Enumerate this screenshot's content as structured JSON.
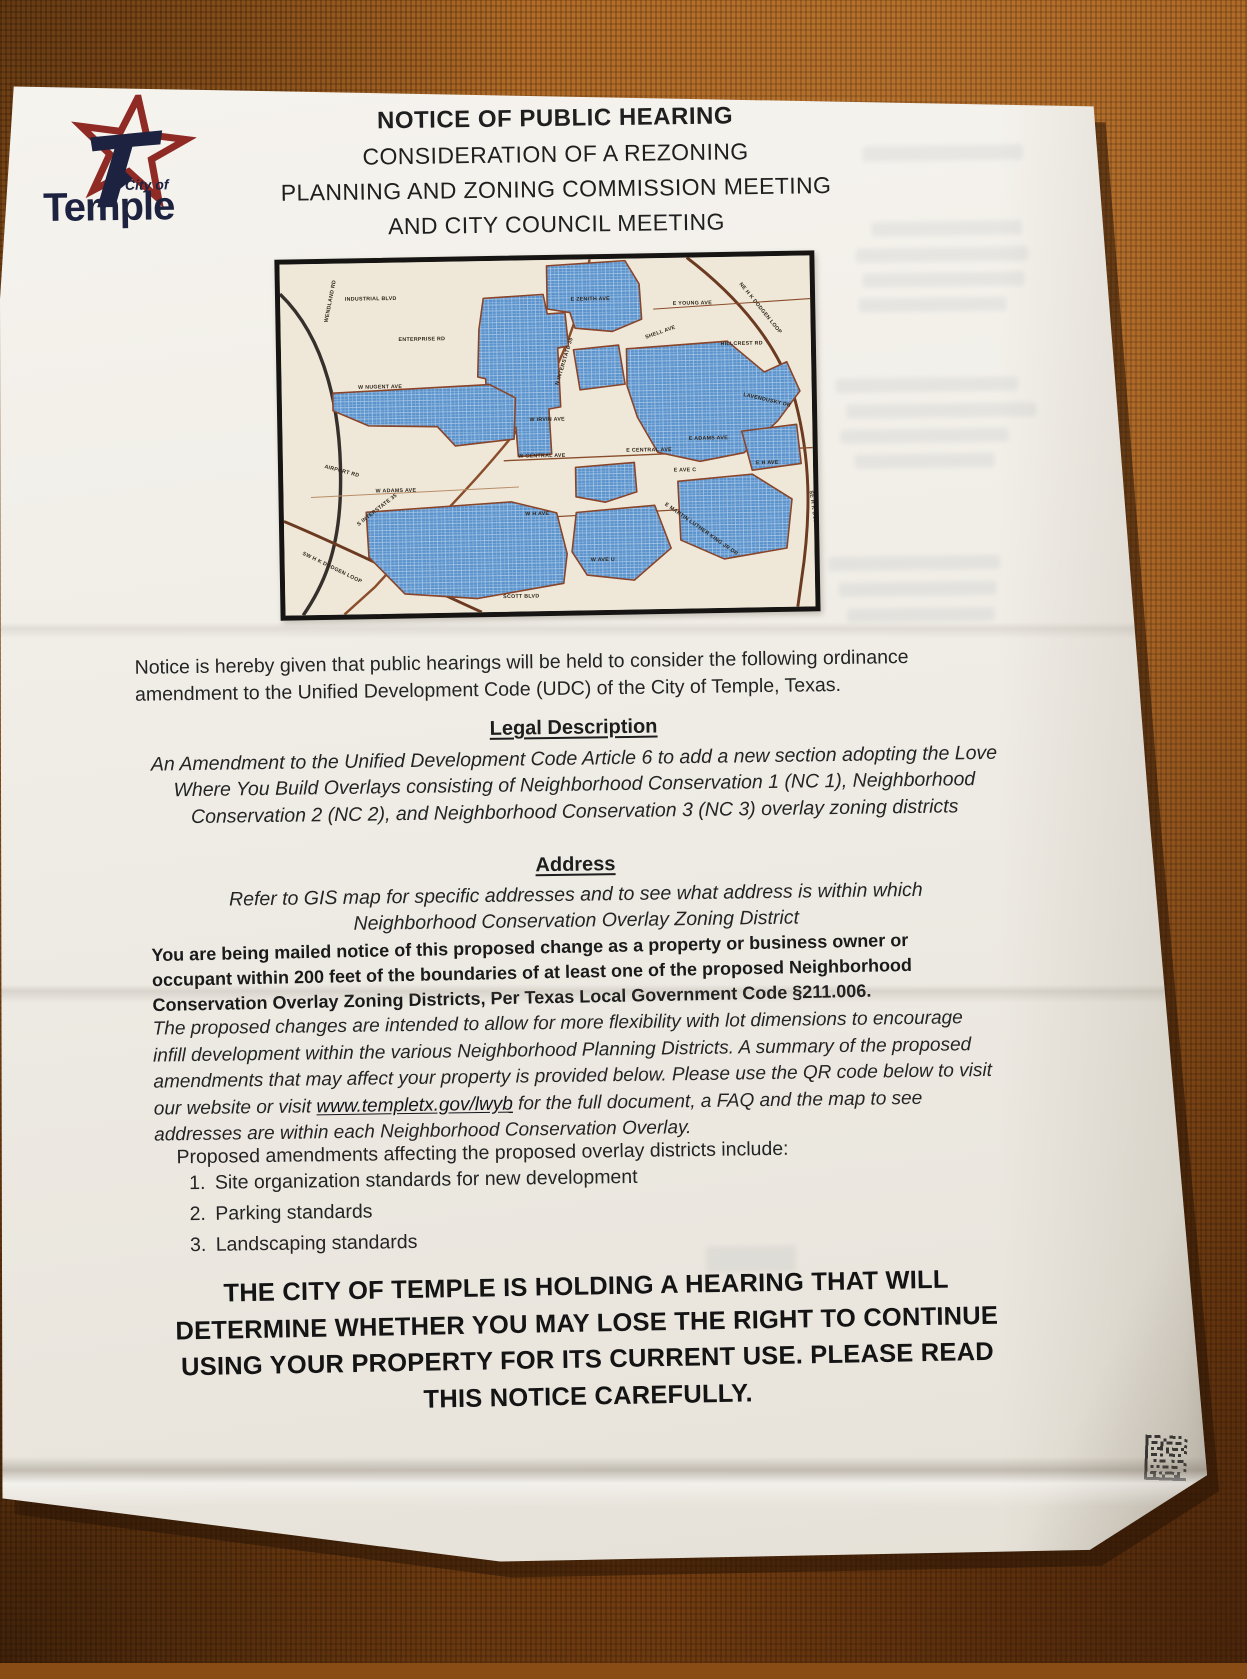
{
  "logo": {
    "city_of": "City of",
    "name": "Temple"
  },
  "header": {
    "lines": [
      "NOTICE OF PUBLIC HEARING",
      "CONSIDERATION OF A REZONING",
      "PLANNING AND ZONING COMMISSION MEETING",
      "AND CITY COUNCIL MEETING"
    ]
  },
  "map": {
    "labels": [
      "INDUSTRIAL BLVD",
      "WENDLAND RD",
      "ENTERPRISE RD",
      "N INTERSTATE 35",
      "W NUGENT AVE",
      "AIRPORT RD",
      "W ADAMS AVE",
      "W CENTRAL AVE",
      "E CENTRAL AVE",
      "E ADAMS AVE",
      "E YOUNG AVE",
      "HILLCREST RD",
      "NE H K DODGEN LOOP",
      "SE H K DODGEN LOOP",
      "SW H K DODGEN LOOP",
      "S INTERSTATE 35",
      "W H AVE",
      "E H AVE",
      "W AVE U",
      "SCOTT BLVD",
      "E MARTIN LUTHER KING JR DR",
      "E ZENITH AVE",
      "SHELL AVE",
      "E AVE C",
      "LAVENDUSKY DR",
      "W IRVIN AVE"
    ]
  },
  "intro": "Notice is hereby given that public hearings will be held to consider the following ordinance amendment to the Unified Development Code (UDC) of the City of Temple, Texas.",
  "legal": {
    "heading": "Legal Description",
    "body": "An Amendment to the Unified Development Code Article 6 to add a new section adopting the Love Where You Build Overlays consisting of Neighborhood Conservation 1 (NC 1), Neighborhood Conservation 2 (NC 2), and Neighborhood Conservation 3 (NC 3) overlay zoning districts"
  },
  "address": {
    "heading": "Address",
    "body": "Refer to GIS map for specific addresses and to see what address is within which Neighborhood Conservation Overlay Zoning District"
  },
  "mailed_notice": "You are being mailed notice of this proposed change as a property or business owner or occupant within 200 feet of the boundaries of at least one of the proposed Neighborhood Conservation Overlay Zoning Districts, Per Texas Local Government Code §211.006.",
  "proposed": {
    "before_link": "The proposed changes are intended to allow for more flexibility with lot dimensions to encourage infill development within the various Neighborhood Planning Districts. A summary of the proposed amendments that may affect your property is provided below. Please use the QR code below to visit our website or visit ",
    "link": "www.templetx.gov/lwyb",
    "after_link": " for the full document, a FAQ and the map to see addresses are within each Neighborhood Conservation Overlay."
  },
  "amendments": {
    "intro": "Proposed amendments affecting the proposed overlay districts include:",
    "items": [
      "Site organization standards for new development",
      "Parking standards",
      "Landscaping standards"
    ]
  },
  "warning": "THE CITY OF TEMPLE IS HOLDING A HEARING THAT WILL DETERMINE WHETHER YOU MAY LOSE THE RIGHT TO CONTINUE USING YOUR PROPERTY FOR ITS CURRENT USE. PLEASE READ THIS NOTICE CAREFULLY.",
  "colors": {
    "logo_red": "#8f2a24",
    "logo_navy": "#1c2240",
    "map_zone_blue": "#5b93cd",
    "map_boundary_brown": "#8a4428",
    "paper": "#f2efe8",
    "fabric": "#a35d1d"
  }
}
